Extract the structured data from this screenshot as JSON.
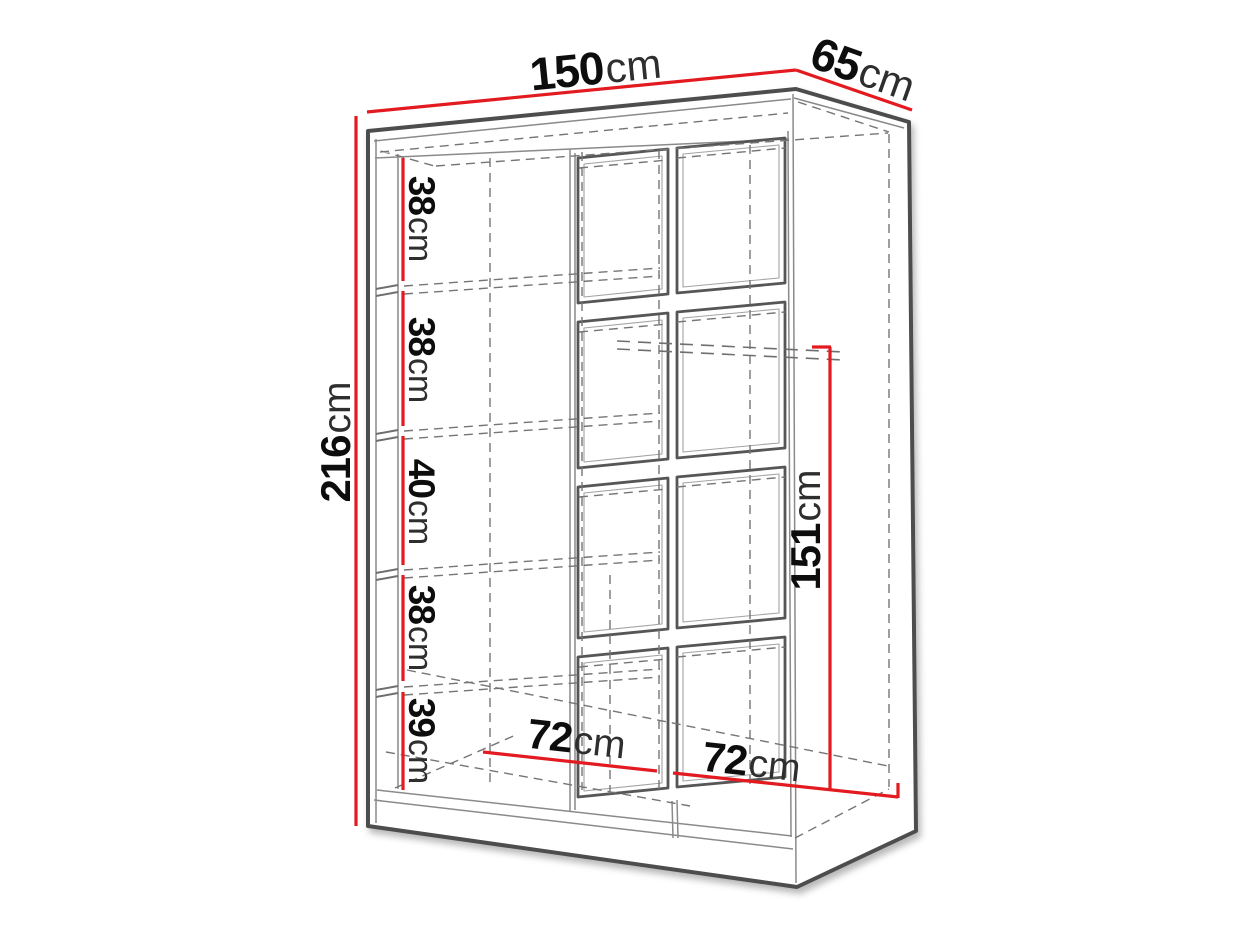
{
  "diagram": {
    "name": "wardrobe-dimension-diagram",
    "unit": "cm",
    "labels": {
      "width": {
        "value": "150",
        "unit": "cm"
      },
      "depth": {
        "value": "65",
        "unit": "cm"
      },
      "height": {
        "value": "216",
        "unit": "cm"
      },
      "shelf_1": {
        "value": "38",
        "unit": "cm"
      },
      "shelf_2": {
        "value": "38",
        "unit": "cm"
      },
      "shelf_3": {
        "value": "40",
        "unit": "cm"
      },
      "shelf_4": {
        "value": "38",
        "unit": "cm"
      },
      "shelf_5": {
        "value": "39",
        "unit": "cm"
      },
      "hanging_height": {
        "value": "151",
        "unit": "cm"
      },
      "inner_width_left": {
        "value": "72",
        "unit": "cm"
      },
      "inner_width_right": {
        "value": "72",
        "unit": "cm"
      }
    },
    "colors": {
      "dimension_line": "#e31b20",
      "edge": "#4e4e4e",
      "hidden_edge": "#757575",
      "label": "#0d0d0d",
      "background": "#ffffff"
    }
  }
}
